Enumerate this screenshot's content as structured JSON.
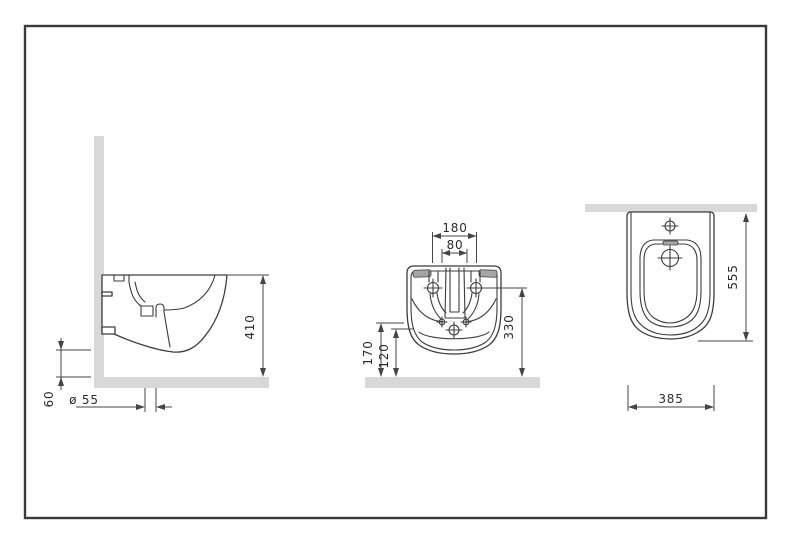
{
  "dimensions": {
    "side_height": "410",
    "side_floor_gap": "60",
    "side_drain_diameter": "ø 55",
    "rear_mount_spacing": "180",
    "rear_inner_spacing": "80",
    "rear_upper_height": "330",
    "rear_mid_height": "170",
    "rear_lower_height": "120",
    "top_depth": "555",
    "top_width": "385"
  },
  "colors": {
    "line": "#3c3c3c",
    "dimension_line": "#454545",
    "surface_gray": "#d8d8d8",
    "slot_gray": "#a6a6a6",
    "frame_border": "#3a3a3a",
    "background": "#ffffff"
  }
}
